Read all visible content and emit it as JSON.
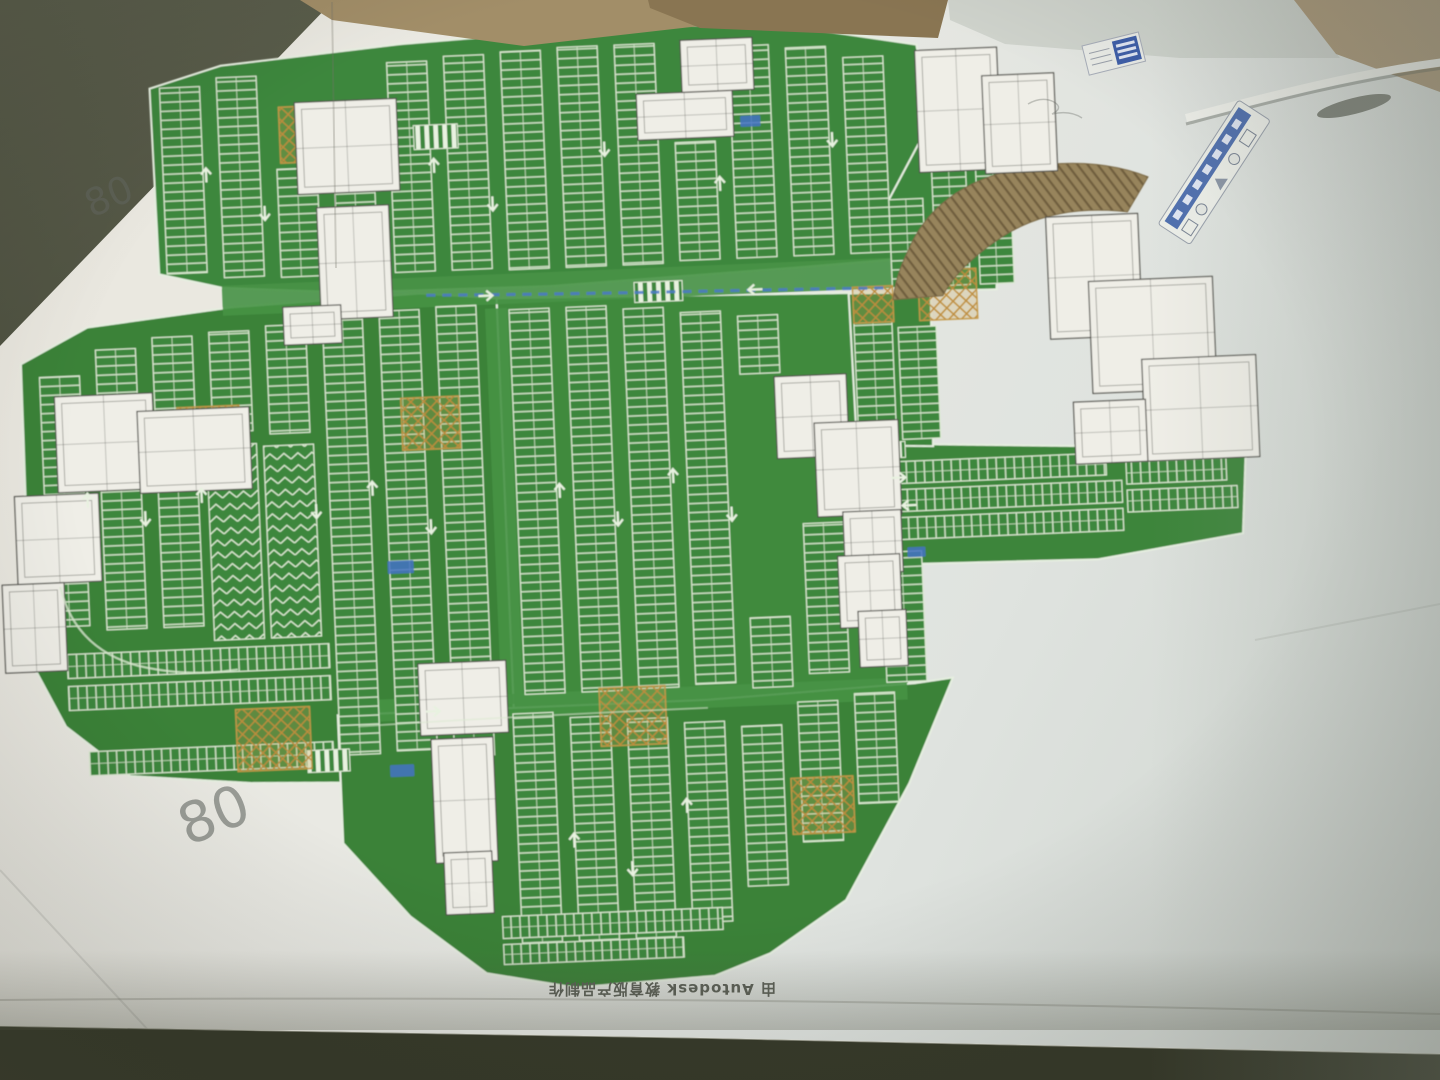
{
  "watermark": {
    "text": "由 Autodesk 教育版产品制作",
    "orientation": "rotated-180"
  },
  "annotations": {
    "pencil_top_left": "80",
    "pencil_left": "80"
  },
  "legend_sticker": {
    "band_color": "#4f6fae",
    "icons": [
      "grid-icon",
      "circle-icon",
      "triangle-icon",
      "circle-icon",
      "grid-icon"
    ]
  },
  "plan": {
    "type": "underground-parking-garage-plan",
    "field_color": "#3e873d",
    "stall_line_color": "#dcead2",
    "building_fill": "#efeee7",
    "building_line": "#50504a",
    "ramp_color": "#97845c",
    "hatch_color": "#bd8c3c",
    "blue_accent": "#4b79c9"
  },
  "scene": {
    "paper_color": "#e8e8e2",
    "table_color": "#4c4f3d",
    "cardboard_color": "#a28e68"
  }
}
